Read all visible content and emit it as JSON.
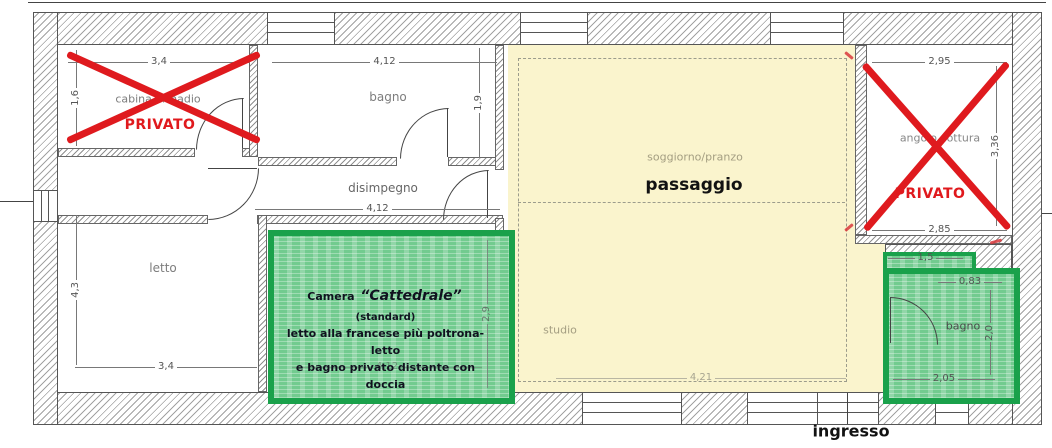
{
  "rooms": {
    "cabina": {
      "label": "cabina armadio"
    },
    "bagno_top": {
      "label": "bagno"
    },
    "disimpegno": {
      "label": "disimpegno"
    },
    "letto": {
      "label": "letto"
    },
    "soggiorno": {
      "label": "soggiorno/pranzo"
    },
    "studio": {
      "label": "studio"
    },
    "angolo_cottura": {
      "label": "angolo cottura"
    },
    "bagno_small": {
      "label": "bagno"
    }
  },
  "annotations": {
    "passaggio": "passaggio",
    "ingresso": "ingresso",
    "privato": "PRIVATO",
    "camera": {
      "prefix": "Camera",
      "name": "“Cattedrale”",
      "suffix": "(standard)",
      "line2": "letto alla francese più poltrona-letto",
      "line3": "e bagno privato distante con doccia"
    }
  },
  "dimensions": {
    "cabina_width": "3,4",
    "cabina_height": "1,6",
    "bagno_width": "4,12",
    "bagno_height": "1,9",
    "disimpegno_width": "4,12",
    "letto_width": "3,4",
    "letto_height": "4,3",
    "camera_width": "4,12",
    "camera_height": "2,9",
    "cottura_width_top": "2,95",
    "cottura_width_bottom": "2,85",
    "cottura_height": "3,36",
    "studio_width": "4,21",
    "bagno_small_width": "2,05",
    "bagno_small_notch_width": "1,5",
    "bagno_small_offset": "0,83",
    "bagno_small_height": "2,0"
  },
  "colors": {
    "highlight_green": "#1aa14b",
    "highlight_green_fill": "#72cb8f",
    "highlight_yellow": "#faf4cd",
    "privato_red": "#e0191d",
    "wall_line": "#555555"
  }
}
